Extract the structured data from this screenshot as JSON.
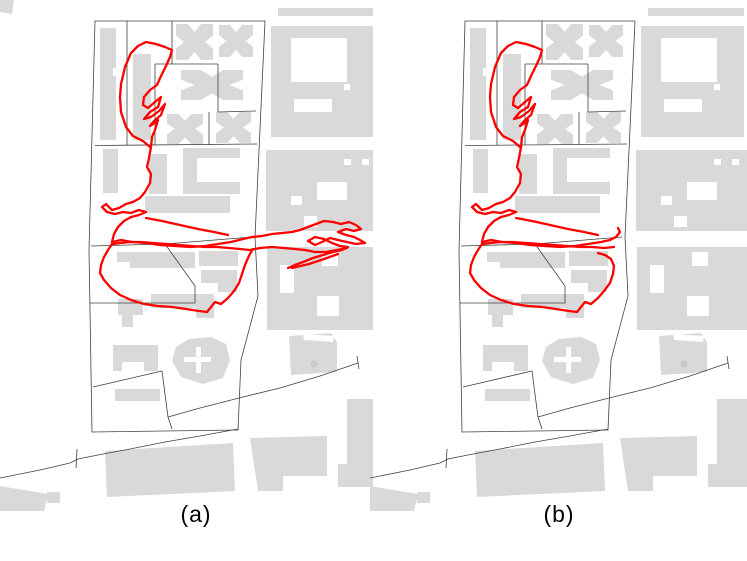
{
  "figure": {
    "panels": [
      {
        "id": "a",
        "label": "(a)"
      },
      {
        "id": "b",
        "label": "(b)"
      }
    ]
  },
  "colors": {
    "background": "#ffffff",
    "building": "#d9d9d9",
    "building_dark": "#c9c9c9",
    "boundary": "#404040",
    "trajectory": "#ff0000"
  },
  "style": {
    "boundary_width": 0.8,
    "trajectory_width": 2.3
  },
  "basemap": {
    "buildings": [
      {
        "name": "corner-blob",
        "kind": "poly",
        "pts": "0,0 14,0 12,14 0,12",
        "only": "a"
      },
      {
        "name": "tower-nw",
        "kind": "poly",
        "pts": "100,28 116,28 116,68 113,68 113,76 116,76 116,140 100,140"
      },
      {
        "name": "tower-n",
        "kind": "rect",
        "x": 133,
        "y": 54,
        "w": 18,
        "h": 86
      },
      {
        "name": "bowtie-building-1",
        "kind": "xblock",
        "x": 176,
        "y": 24,
        "w": 37,
        "h": 36
      },
      {
        "name": "bowtie-building-2",
        "kind": "xblock",
        "x": 219,
        "y": 25,
        "w": 34,
        "h": 32
      },
      {
        "name": "h-building",
        "kind": "xblock",
        "x": 181,
        "y": 70,
        "w": 62,
        "h": 30
      },
      {
        "name": "bowtie-building-3",
        "kind": "xblock",
        "x": 167,
        "y": 114,
        "w": 36,
        "h": 30
      },
      {
        "name": "bowtie-building-4",
        "kind": "xblock",
        "x": 216,
        "y": 112,
        "w": 35,
        "h": 31
      },
      {
        "name": "tower-mid",
        "kind": "rect",
        "x": 103,
        "y": 149,
        "w": 15,
        "h": 44
      },
      {
        "name": "slab-mid",
        "kind": "rect",
        "x": 149,
        "y": 154,
        "w": 18,
        "h": 40
      },
      {
        "name": "u-building",
        "kind": "rect",
        "x": 183,
        "y": 148,
        "w": 57,
        "h": 46
      },
      {
        "name": "u-building-courtyard",
        "kind": "rect",
        "x": 197,
        "y": 158,
        "w": 43,
        "h": 24,
        "fill": "cut"
      },
      {
        "name": "wide-slab",
        "kind": "rect",
        "x": 145,
        "y": 196,
        "w": 85,
        "h": 17
      },
      {
        "name": "slab-lower-1",
        "kind": "poly",
        "pts": "117,252 195,252 195,268 130,268 130,262 117,262"
      },
      {
        "name": "slab-lower-2",
        "kind": "rect",
        "x": 199,
        "y": 251,
        "w": 39,
        "h": 15
      },
      {
        "name": "slab-lower-3",
        "kind": "poly",
        "pts": "201,270 237,270 237,292 218,292 218,283 201,283"
      },
      {
        "name": "cluster-building",
        "kind": "poly",
        "pts": "118,299 143,299 143,315 133,315 133,327 122,327 122,315 118,315"
      },
      {
        "name": "slab-lower-4",
        "kind": "poly",
        "pts": "151,294 214,294 214,318 196,318 196,308 151,308"
      },
      {
        "name": "slab-sw",
        "kind": "poly",
        "pts": "113,345 158,345 158,371 144,371 144,362 122,362 122,371 113,371"
      },
      {
        "name": "slab-thin",
        "kind": "rect",
        "x": 115,
        "y": 389,
        "w": 45,
        "h": 12
      },
      {
        "name": "castle-building",
        "kind": "poly",
        "pts": "176,347 189,339 211,337 226,344 230,360 223,378 203,384 181,377 172,361"
      },
      {
        "name": "castle-cross-h",
        "kind": "rect",
        "x": 184,
        "y": 357,
        "w": 27,
        "h": 5,
        "fill": "cut"
      },
      {
        "name": "castle-cross-v",
        "kind": "rect",
        "x": 196,
        "y": 347,
        "w": 5,
        "h": 26,
        "fill": "cut"
      },
      {
        "name": "bar-ne",
        "kind": "rect",
        "x": 278,
        "y": 8,
        "w": 96,
        "h": 8
      },
      {
        "name": "block-ne",
        "kind": "rect",
        "x": 271,
        "y": 26,
        "w": 103,
        "h": 111
      },
      {
        "name": "block-ne-courtyard",
        "kind": "rect",
        "x": 291,
        "y": 38,
        "w": 56,
        "h": 44,
        "fill": "cut"
      },
      {
        "name": "block-ne-notch",
        "kind": "rect",
        "x": 294,
        "y": 99,
        "w": 38,
        "h": 13,
        "fill": "cut"
      },
      {
        "name": "block-ne-gap",
        "kind": "rect",
        "x": 344,
        "y": 84,
        "w": 6,
        "h": 6,
        "fill": "cut"
      },
      {
        "name": "block-e",
        "kind": "rect",
        "x": 266,
        "y": 150,
        "w": 111,
        "h": 81
      },
      {
        "name": "block-e-gap1",
        "kind": "rect",
        "x": 317,
        "y": 182,
        "w": 30,
        "h": 18,
        "fill": "cut"
      },
      {
        "name": "block-e-gap2",
        "kind": "rect",
        "x": 291,
        "y": 196,
        "w": 11,
        "h": 9,
        "fill": "cut"
      },
      {
        "name": "block-e-gap3",
        "kind": "rect",
        "x": 304,
        "y": 216,
        "w": 13,
        "h": 11,
        "fill": "cut"
      },
      {
        "name": "block-e-gap4",
        "kind": "rect",
        "x": 344,
        "y": 159,
        "w": 7,
        "h": 6,
        "fill": "cut"
      },
      {
        "name": "block-e-gap5",
        "kind": "rect",
        "x": 362,
        "y": 159,
        "w": 7,
        "h": 6,
        "fill": "cut"
      },
      {
        "name": "block-se",
        "kind": "rect",
        "x": 267,
        "y": 247,
        "w": 110,
        "h": 83
      },
      {
        "name": "block-se-gap1",
        "kind": "rect",
        "x": 280,
        "y": 265,
        "w": 14,
        "h": 28,
        "fill": "cut"
      },
      {
        "name": "block-se-gap2",
        "kind": "rect",
        "x": 322,
        "y": 252,
        "w": 16,
        "h": 14,
        "fill": "cut"
      },
      {
        "name": "block-se-gap3",
        "kind": "rect",
        "x": 317,
        "y": 296,
        "w": 22,
        "h": 20,
        "fill": "cut"
      },
      {
        "name": "dot-building",
        "kind": "poly",
        "pts": "289,336 331,333 337,342 337,372 291,375"
      },
      {
        "name": "dot-building-slit",
        "kind": "poly",
        "pts": "303,334 334,336 333,342 304,340",
        "fill": "cut"
      },
      {
        "name": "roof-dot",
        "kind": "circle",
        "cx": 314,
        "cy": 364,
        "r": 3.5,
        "fill": "#c9c9c9"
      },
      {
        "name": "block-e2",
        "kind": "rect",
        "x": 347,
        "y": 399,
        "w": 30,
        "h": 66
      },
      {
        "name": "block-s1",
        "kind": "poly",
        "pts": "250,438 327,436 327,476 283,476 283,491 258,491"
      },
      {
        "name": "block-s2",
        "kind": "poly",
        "pts": "105,451 233,443 235,491 107,497"
      },
      {
        "name": "block-s3",
        "kind": "rect",
        "x": 338,
        "y": 464,
        "w": 39,
        "h": 23
      },
      {
        "name": "wedge-sw",
        "kind": "poly",
        "pts": "0,486 48,494 44,511 0,511"
      },
      {
        "name": "square-sw",
        "kind": "rect",
        "x": 47,
        "y": 492,
        "w": 13,
        "h": 11
      }
    ],
    "lines": [
      {
        "name": "parcel-outline",
        "closed": true,
        "pts": "95,21 265,21 255,237 258,296 241,360 238,430 92,432 89,250"
      },
      {
        "name": "divider-top",
        "pts": "95,145.5 257,144"
      },
      {
        "name": "divider-mid",
        "pts": "91,246 165,244 252,237"
      },
      {
        "name": "lot-line-1",
        "pts": "127,21 127,145"
      },
      {
        "name": "lot-line-2",
        "pts": "172,21 172,64"
      },
      {
        "name": "lot-line-3",
        "pts": "155,64 218,64"
      },
      {
        "name": "lot-line-4",
        "pts": "155,64 155,145"
      },
      {
        "name": "lot-line-5",
        "pts": "218,64 218,112"
      },
      {
        "name": "lot-line-6",
        "pts": "218,112 256,111"
      },
      {
        "name": "lot-line-7",
        "pts": "209,112 209,145"
      },
      {
        "name": "pentagon-lot",
        "pts": "165,244 195,286 195,303 90,303"
      },
      {
        "name": "inner-lot",
        "pts": "93,387 162,371 168,417 172,429"
      },
      {
        "name": "road-main",
        "pts": "0,478 40,470 70,463 78,459 98,455 130,449 165,442 200,436 238,429"
      },
      {
        "name": "road-tick",
        "pts": "77,449 76,468"
      },
      {
        "name": "road-diagonal",
        "pts": "168,417 200,408 243,397 280,388 320,376 358,363"
      },
      {
        "name": "road-diagonal-tick",
        "pts": "357,356 359,369"
      }
    ]
  },
  "trajectories": {
    "a": [
      "150,147 143,141 133,136 126,127 121,112 120,97 121,84 125,67 131,53 138,46 146,42 156,44 165,47 172,50 170,57 166,66 161,76 157,85 150,90 144,97 143,105 148,108 155,102 161,97 158,107 150,112 144,119 151,117 159,111 165,104 161,115 154,121 150,126 153,124 158,120 155,130 152,137 151,147 149,158 147,167 151,174 150,183 145,192 140,198 133,202 126,204 119,208 112,210 106,204 102,207 107,212 115,214 123,212 131,213 139,210 146,212 139,215 131,217 124,221 118,227 114,234 112,242",
      "112,242 121,240 132,242 146,243 160,245 175,246 190,247 205,246 218,244 231,242 243,239 252,237 262,236 272,234 282,233 292,232 300,230 308,227 316,224 324,221 333,222 341,224 349,222 356,225 361,229 354,231 346,229 338,232 346,235 354,237 360,240 365,243 356,244 347,242 338,240 330,238 322,242 315,245 308,241 315,237 324,239 332,243 340,246 348,247 342,250 333,252 323,255 313,258 303,262 295,265 288,268",
      "347,248 337,250 326,252 315,252 305,250 295,249 284,248 272,247 260,248 250,250 240,249 229,248 217,247 205,247 192,246 179,245 166,244 153,243 141,242 130,242 120,243 113,244",
      "292,268 309,264 324,259 338,254",
      "112,244 108,250 104,257 101,265 100,273 104,280 111,288 120,295 131,300 144,304 158,306 172,307 186,309 199,311 207,312 211,307 215,302 221,304 228,298 234,291 239,283 242,274 245,265 248,258 251,252 253,249",
      "146,218 162,221 180,225 198,229 214,232 228,235"
    ],
    "b": [
      "150,147 143,141 133,136 126,127 121,112 120,97 121,84 125,67 131,53 138,46 146,42 156,44 165,47 172,50 170,57 166,66 161,76 157,85 150,90 144,97 143,105 148,108 155,102 161,97 158,107 150,112 144,119 151,117 159,111 165,104 161,115 154,121 150,126 153,124 158,120 155,130 152,137 151,147 149,158 147,167 151,174 150,183 145,192 140,198 133,202 126,204 119,208 112,210 106,204 102,207 107,212 115,214 123,212 131,213 139,210 146,212 139,215 131,217 124,221 118,227 114,234 112,242",
      "112,242 121,240 132,242 146,243 160,245 175,246 190,247 205,246 218,244 231,242 240,240 246,237 250,232 248,228",
      "244,247 234,248 222,247 210,247 197,246 184,245 170,244 156,243 143,242 131,242 120,243 113,244",
      "112,244 108,250 104,257 101,265 100,273 104,280 111,288 120,295 131,300 144,304 158,306 172,307 186,309 199,311 207,312 211,307 215,302 221,304 228,298 234,291 240,283 243,274 244,266 241,259 235,255 228,253",
      "146,218 162,221 180,225 198,229 214,232 228,235"
    ]
  }
}
